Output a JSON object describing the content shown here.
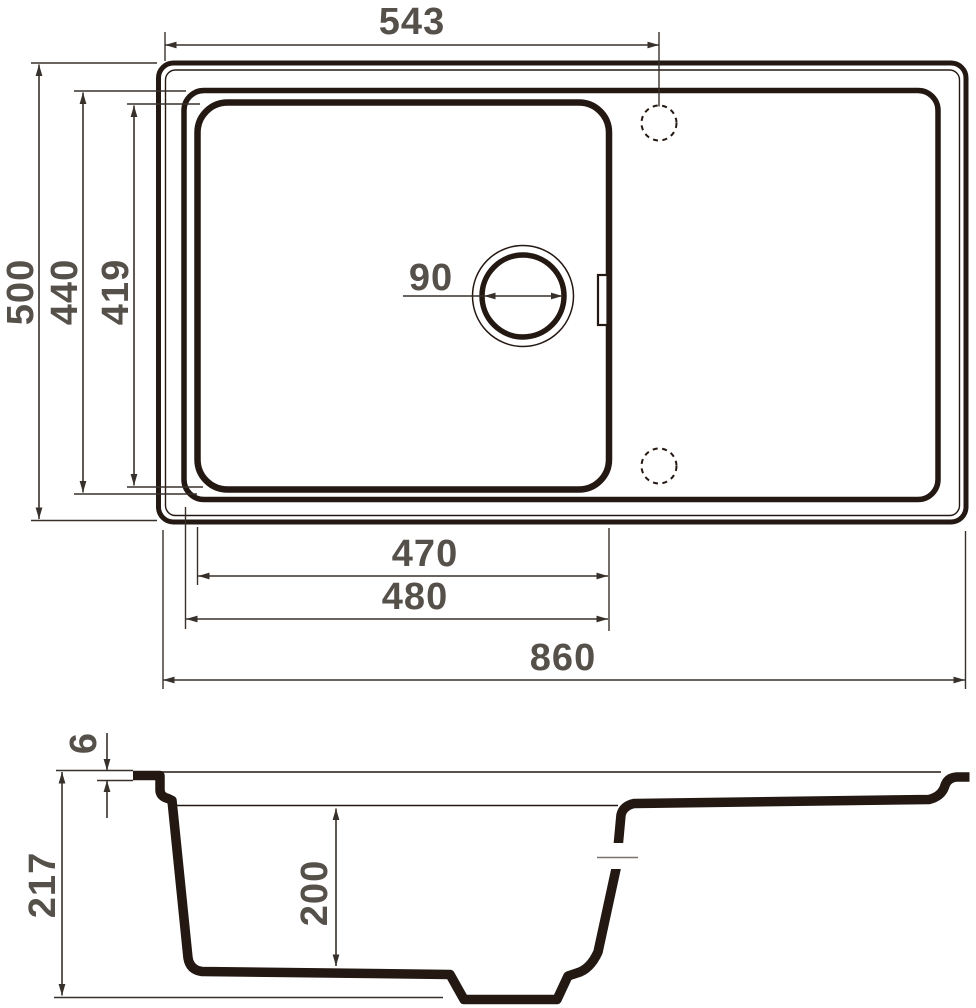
{
  "colors": {
    "outline": "#241812",
    "dimension_lines": "#38312B",
    "labels": "#56504A",
    "background": "#FFFFFF"
  },
  "top_view": {
    "faucet_offset_mm": "543",
    "overall_depth_mm": "500",
    "rim_inner_depth_mm": "440",
    "bowl_depth_mm": "419",
    "drain_diameter_mm": "90",
    "bowl_bottom_width_mm": "470",
    "bowl_width_mm": "480",
    "overall_width_mm": "860"
  },
  "section_view": {
    "rim_thickness_mm": "6",
    "overall_height_mm": "217",
    "bowl_depth_mm": "200"
  }
}
